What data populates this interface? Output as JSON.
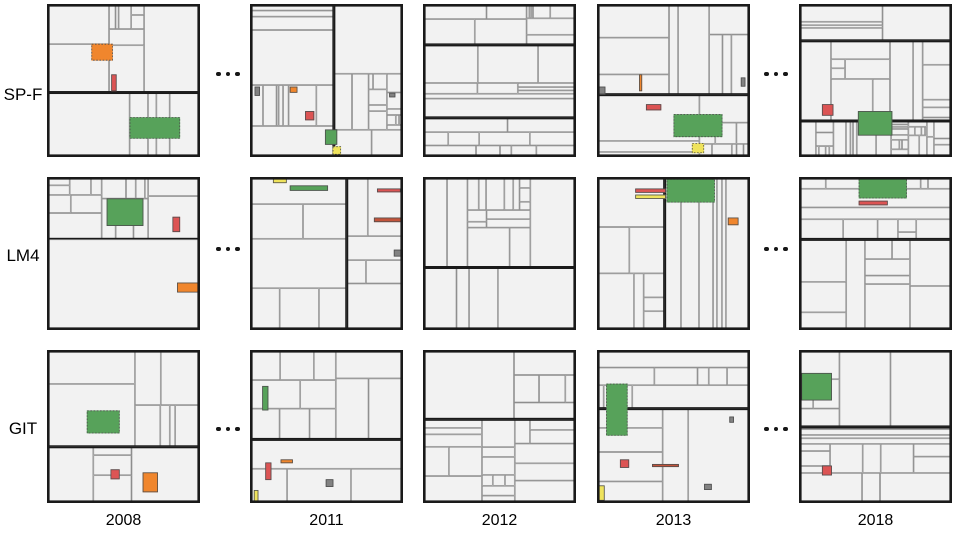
{
  "figure": {
    "rows": [
      {
        "label": "SP-F"
      },
      {
        "label": "LM4"
      },
      {
        "label": "GIT"
      }
    ],
    "years": [
      "2008",
      "2011",
      "2012",
      "2013",
      "2018"
    ],
    "ellipsis": "...",
    "colors": {
      "green": "#57A25A",
      "red": "#DC5454",
      "orange": "#F0862D",
      "yellow": "#EFE35C",
      "gray": "#828282",
      "rust": "#C2543B",
      "cell_fill": "#F2F2F2",
      "cell_border": "#8F8F8F",
      "group_border": "#1A1A1A",
      "background": "#FFFFFF"
    },
    "treemaps": [
      [
        {
          "seed": 11,
          "highlights": [
            {
              "color": "orange",
              "x": 0.29,
              "y": 0.26,
              "w": 0.14,
              "h": 0.11,
              "dotted": true
            },
            {
              "color": "red",
              "x": 0.42,
              "y": 0.46,
              "w": 0.035,
              "h": 0.11
            },
            {
              "color": "green",
              "x": 0.54,
              "y": 0.74,
              "w": 0.33,
              "h": 0.14,
              "dotted": true
            }
          ]
        },
        {
          "seed": 23,
          "highlights": [
            {
              "color": "gray",
              "x": 0.03,
              "y": 0.54,
              "w": 0.035,
              "h": 0.06
            },
            {
              "color": "orange",
              "x": 0.26,
              "y": 0.54,
              "w": 0.05,
              "h": 0.04
            },
            {
              "color": "gray",
              "x": 0.91,
              "y": 0.58,
              "w": 0.04,
              "h": 0.03
            },
            {
              "color": "red",
              "x": 0.36,
              "y": 0.7,
              "w": 0.06,
              "h": 0.06
            },
            {
              "color": "green",
              "x": 0.49,
              "y": 0.82,
              "w": 0.08,
              "h": 0.1
            },
            {
              "color": "yellow",
              "x": 0.54,
              "y": 0.93,
              "w": 0.055,
              "h": 0.055,
              "dotted": true
            }
          ]
        },
        {
          "seed": 37,
          "highlights": []
        },
        {
          "seed": 41,
          "highlights": [
            {
              "color": "gray",
              "x": 0.01,
              "y": 0.54,
              "w": 0.045,
              "h": 0.05
            },
            {
              "color": "orange",
              "x": 0.275,
              "y": 0.46,
              "w": 0.02,
              "h": 0.11
            },
            {
              "color": "gray",
              "x": 0.94,
              "y": 0.48,
              "w": 0.03,
              "h": 0.06
            },
            {
              "color": "red",
              "x": 0.32,
              "y": 0.655,
              "w": 0.1,
              "h": 0.04
            },
            {
              "color": "green",
              "x": 0.5,
              "y": 0.72,
              "w": 0.32,
              "h": 0.15,
              "dotted": true
            },
            {
              "color": "yellow",
              "x": 0.62,
              "y": 0.91,
              "w": 0.08,
              "h": 0.065,
              "dotted": true
            }
          ]
        },
        {
          "seed": 53,
          "highlights": [
            {
              "color": "red",
              "x": 0.15,
              "y": 0.655,
              "w": 0.075,
              "h": 0.075
            },
            {
              "color": "green",
              "x": 0.385,
              "y": 0.7,
              "w": 0.225,
              "h": 0.16
            }
          ]
        }
      ],
      [
        {
          "seed": 61,
          "highlights": [
            {
              "color": "green",
              "x": 0.39,
              "y": 0.14,
              "w": 0.24,
              "h": 0.18
            },
            {
              "color": "red",
              "x": 0.82,
              "y": 0.26,
              "w": 0.05,
              "h": 0.1
            },
            {
              "color": "orange",
              "x": 0.85,
              "y": 0.69,
              "w": 0.14,
              "h": 0.065
            }
          ]
        },
        {
          "seed": 71,
          "highlights": [
            {
              "color": "yellow",
              "x": 0.15,
              "y": 0.01,
              "w": 0.09,
              "h": 0.03
            },
            {
              "color": "green",
              "x": 0.26,
              "y": 0.055,
              "w": 0.25,
              "h": 0.035
            },
            {
              "color": "red",
              "x": 0.83,
              "y": 0.075,
              "w": 0.155,
              "h": 0.025
            },
            {
              "color": "rust",
              "x": 0.81,
              "y": 0.265,
              "w": 0.18,
              "h": 0.03
            },
            {
              "color": "gray",
              "x": 0.94,
              "y": 0.475,
              "w": 0.05,
              "h": 0.045
            }
          ]
        },
        {
          "seed": 83,
          "highlights": []
        },
        {
          "seed": 97,
          "highlights": [
            {
              "color": "red",
              "x": 0.25,
              "y": 0.075,
              "w": 0.2,
              "h": 0.028
            },
            {
              "color": "yellow",
              "x": 0.25,
              "y": 0.115,
              "w": 0.2,
              "h": 0.028
            },
            {
              "color": "green",
              "x": 0.455,
              "y": 0.012,
              "w": 0.315,
              "h": 0.155,
              "dotted": true
            },
            {
              "color": "orange",
              "x": 0.855,
              "y": 0.265,
              "w": 0.07,
              "h": 0.05
            }
          ]
        },
        {
          "seed": 101,
          "highlights": [
            {
              "color": "green",
              "x": 0.39,
              "y": 0.01,
              "w": 0.315,
              "h": 0.13,
              "dotted": true
            },
            {
              "color": "red",
              "x": 0.39,
              "y": 0.155,
              "w": 0.19,
              "h": 0.03
            }
          ]
        }
      ],
      [
        {
          "seed": 113,
          "highlights": [
            {
              "color": "green",
              "x": 0.26,
              "y": 0.395,
              "w": 0.215,
              "h": 0.15,
              "dotted": true
            },
            {
              "color": "red",
              "x": 0.415,
              "y": 0.78,
              "w": 0.06,
              "h": 0.065
            },
            {
              "color": "orange",
              "x": 0.625,
              "y": 0.8,
              "w": 0.1,
              "h": 0.13
            }
          ]
        },
        {
          "seed": 127,
          "highlights": [
            {
              "color": "green",
              "x": 0.08,
              "y": 0.235,
              "w": 0.04,
              "h": 0.16
            },
            {
              "color": "orange",
              "x": 0.2,
              "y": 0.715,
              "w": 0.08,
              "h": 0.025
            },
            {
              "color": "red",
              "x": 0.1,
              "y": 0.735,
              "w": 0.04,
              "h": 0.115
            },
            {
              "color": "gray",
              "x": 0.495,
              "y": 0.845,
              "w": 0.05,
              "h": 0.05
            },
            {
              "color": "yellow",
              "x": 0.025,
              "y": 0.915,
              "w": 0.03,
              "h": 0.075
            }
          ]
        },
        {
          "seed": 139,
          "highlights": []
        },
        {
          "seed": 149,
          "highlights": [
            {
              "color": "green",
              "x": 0.06,
              "y": 0.22,
              "w": 0.14,
              "h": 0.34,
              "dotted": true
            },
            {
              "color": "red",
              "x": 0.15,
              "y": 0.715,
              "w": 0.06,
              "h": 0.055
            },
            {
              "color": "rust",
              "x": 0.36,
              "y": 0.745,
              "w": 0.175,
              "h": 0.02
            },
            {
              "color": "yellow",
              "x": 0.01,
              "y": 0.885,
              "w": 0.04,
              "h": 0.1
            },
            {
              "color": "gray",
              "x": 0.7,
              "y": 0.875,
              "w": 0.05,
              "h": 0.04
            },
            {
              "color": "gray",
              "x": 0.865,
              "y": 0.435,
              "w": 0.03,
              "h": 0.04
            }
          ]
        },
        {
          "seed": 157,
          "highlights": [
            {
              "color": "green",
              "x": 0.015,
              "y": 0.15,
              "w": 0.2,
              "h": 0.18
            },
            {
              "color": "red",
              "x": 0.15,
              "y": 0.755,
              "w": 0.065,
              "h": 0.065
            }
          ]
        }
      ]
    ]
  },
  "chart_data": {
    "type": "treemap",
    "layout": "small-multiples grid, 3 rows x 5 columns, ellipses mark omitted years",
    "rows": [
      "SP-F",
      "LM4",
      "GIT"
    ],
    "columns": [
      "2008",
      "2011",
      "2012",
      "2013",
      "2018"
    ],
    "ellipsis_between": [
      [
        "2008",
        "2011"
      ],
      [
        "2013",
        "2018"
      ]
    ],
    "legend_position": "none",
    "grid": false,
    "panels": [
      {
        "row": "SP-F",
        "year": "2008",
        "highlight_colors": [
          "orange",
          "red",
          "green"
        ]
      },
      {
        "row": "SP-F",
        "year": "2011",
        "highlight_colors": [
          "gray",
          "orange",
          "red",
          "green",
          "yellow"
        ]
      },
      {
        "row": "SP-F",
        "year": "2012",
        "highlight_colors": []
      },
      {
        "row": "SP-F",
        "year": "2013",
        "highlight_colors": [
          "gray",
          "orange",
          "red",
          "green",
          "yellow"
        ]
      },
      {
        "row": "SP-F",
        "year": "2018",
        "highlight_colors": [
          "red",
          "green"
        ]
      },
      {
        "row": "LM4",
        "year": "2008",
        "highlight_colors": [
          "green",
          "red",
          "orange"
        ]
      },
      {
        "row": "LM4",
        "year": "2011",
        "highlight_colors": [
          "yellow",
          "green",
          "red",
          "rust",
          "gray"
        ]
      },
      {
        "row": "LM4",
        "year": "2012",
        "highlight_colors": []
      },
      {
        "row": "LM4",
        "year": "2013",
        "highlight_colors": [
          "red",
          "yellow",
          "green",
          "orange"
        ]
      },
      {
        "row": "LM4",
        "year": "2018",
        "highlight_colors": [
          "green",
          "red"
        ]
      },
      {
        "row": "GIT",
        "year": "2008",
        "highlight_colors": [
          "green",
          "red",
          "orange"
        ]
      },
      {
        "row": "GIT",
        "year": "2011",
        "highlight_colors": [
          "green",
          "orange",
          "red",
          "gray",
          "yellow"
        ]
      },
      {
        "row": "GIT",
        "year": "2012",
        "highlight_colors": []
      },
      {
        "row": "GIT",
        "year": "2013",
        "highlight_colors": [
          "green",
          "red",
          "rust",
          "yellow",
          "gray"
        ]
      },
      {
        "row": "GIT",
        "year": "2018",
        "highlight_colors": [
          "green",
          "red"
        ]
      }
    ]
  }
}
